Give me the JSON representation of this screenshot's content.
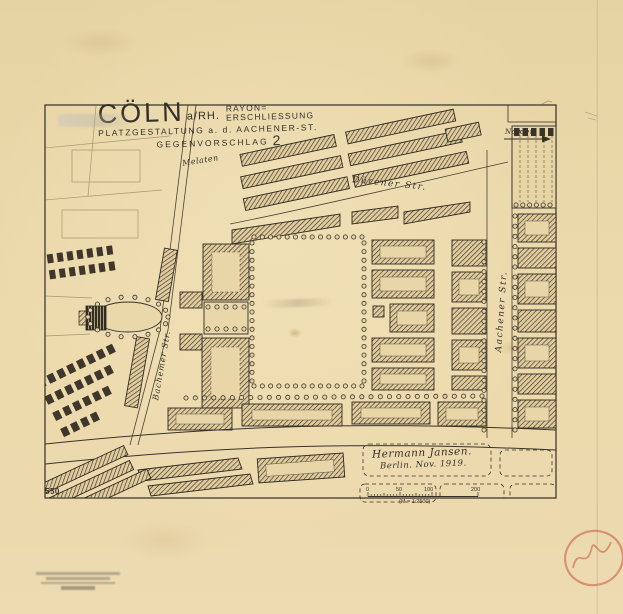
{
  "title": {
    "city": "CÖLN",
    "city_suffix": "a/RH.",
    "subtitle_top": "RAYON=",
    "subtitle_bottom": "ERSCHLIESSUNG",
    "line2": "PLATZGESTALTUNG a. d. AACHENER-ST.",
    "line3_label": "GEGENVORSCHLAG",
    "line3_number": "2"
  },
  "north_arrow": {
    "label": "Norden"
  },
  "street_labels": {
    "duerener": "Dürener Str.",
    "aachener": "Aachener Str.",
    "bachemer": "Bachemer Str.",
    "melaten": "Melaten"
  },
  "signature": {
    "line1": "Hermann Jansen.",
    "line2": "Berlin.  Nov. 1919."
  },
  "scale_bar": {
    "tick_0": "0",
    "tick_50": "50",
    "tick_100": "100",
    "tick_200": "200",
    "ratio": "(M = 1:2500)"
  },
  "sheet_number": "550",
  "colors": {
    "paper": "#e9d7a9",
    "ink": "#342e25",
    "red_crayon": "#c7573f"
  }
}
